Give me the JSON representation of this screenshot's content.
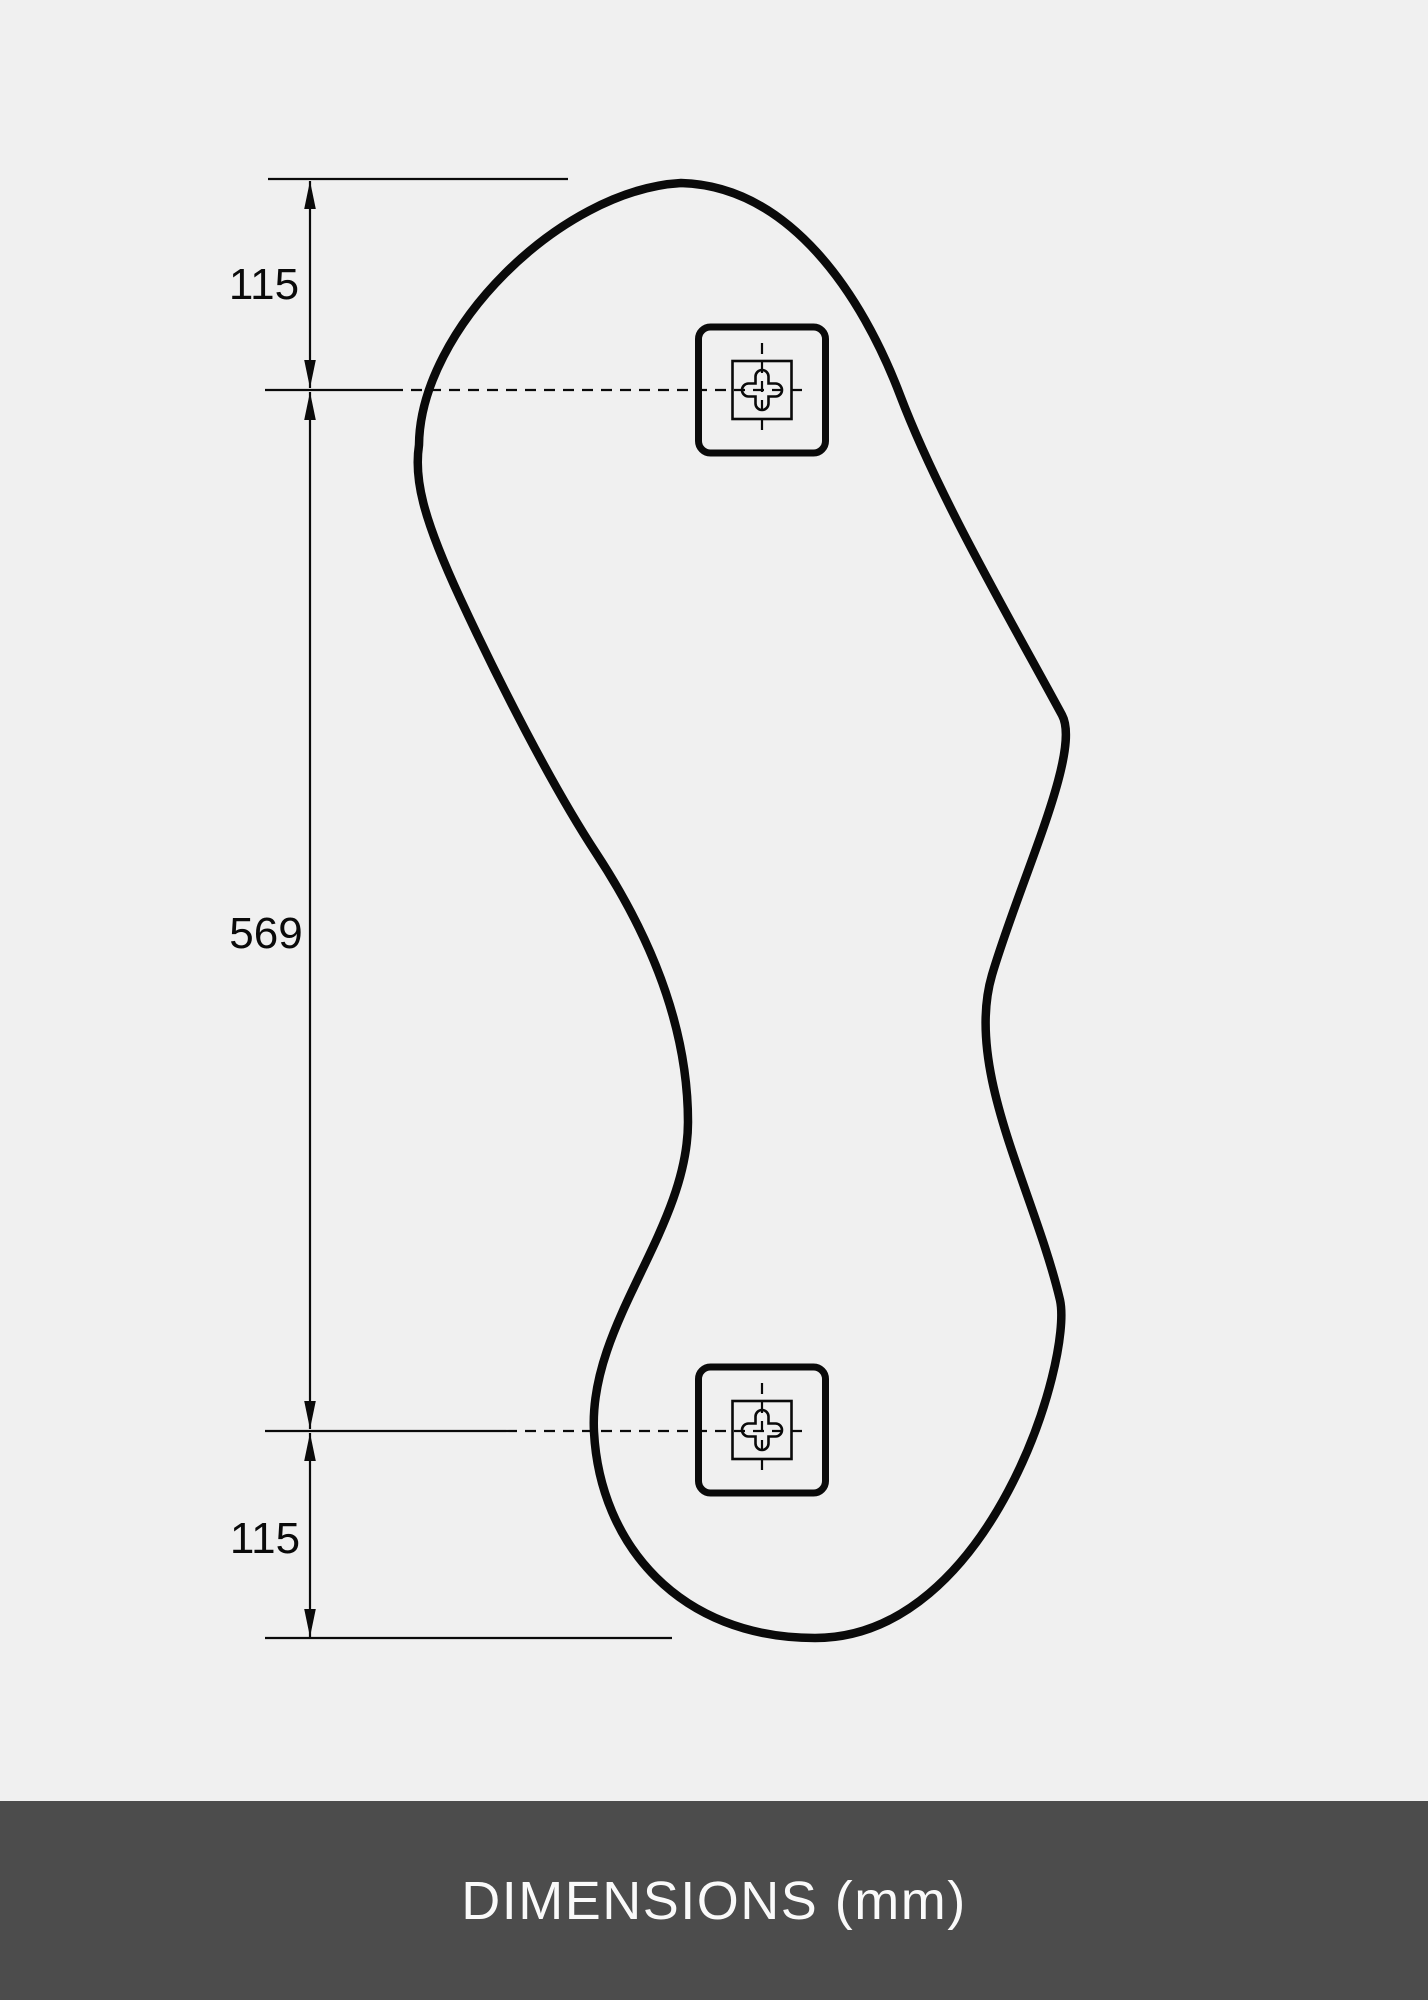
{
  "page": {
    "background_color": "#f0f0f0",
    "line_color": "#0a0a0a"
  },
  "diagram": {
    "type": "technical-dimension-drawing",
    "subject": "organic-shaped mirror with two wall-mount brackets",
    "unit": "mm",
    "dimensions": [
      {
        "id": "top-offset",
        "label": "115"
      },
      {
        "id": "bracket-span",
        "label": "569"
      },
      {
        "id": "bottom-offset",
        "label": "115"
      }
    ],
    "icons": {
      "mount_bracket_top": "wall-mount-bracket-icon",
      "mount_bracket_bottom": "wall-mount-bracket-icon",
      "crosshair": "centerline-crosshair-icon"
    }
  },
  "footer": {
    "label": "DIMENSIONS (mm)",
    "background_color": "#4c4c4c",
    "text_color": "#fafafa"
  }
}
